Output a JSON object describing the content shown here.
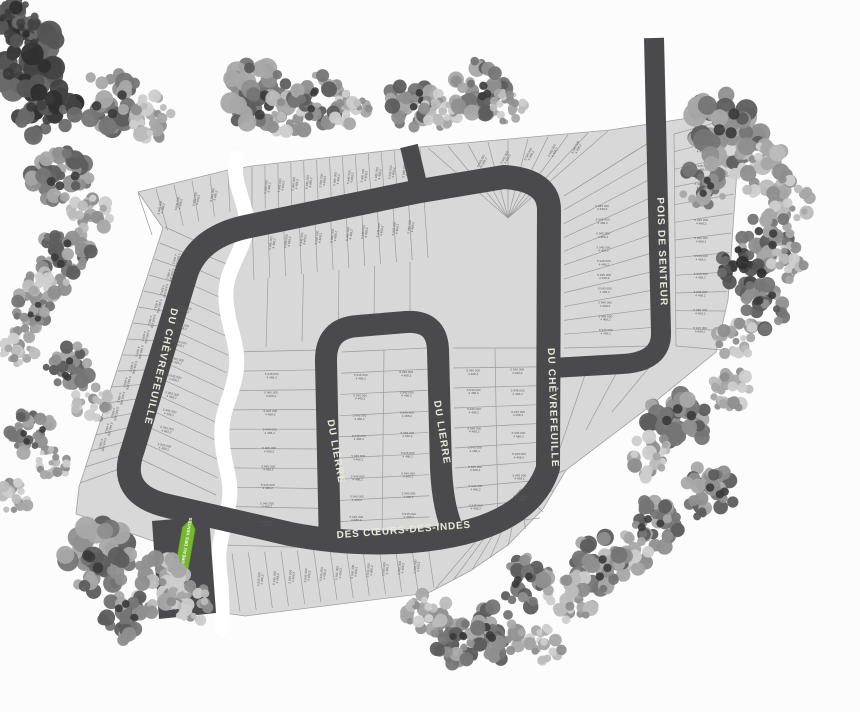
{
  "page": {
    "width": 860,
    "height": 712,
    "background": "#fcfcfc"
  },
  "palette": {
    "plat_fill": "#d8d8d8",
    "plat_line": "#9b9b9b",
    "plat_outline": "#a0a0a0",
    "road": "#4a4a4c",
    "road_text": "#e9e9db",
    "creek": "#ffffff",
    "lot_text": "#5d5d5d",
    "arrow_green": "#75b72e",
    "arrow_text": "#ffffff",
    "tree_tones": [
      [
        "#2f2f2f",
        "#424242",
        "#555555",
        "#6a6a6a"
      ],
      [
        "#5d5d5d",
        "#757575",
        "#8f8f8f",
        "#a8a8a8"
      ],
      [
        "#8e8e8e",
        "#a6a6a6",
        "#bcbcbc",
        "#cdcdcd"
      ]
    ]
  },
  "map": {
    "roads": [
      {
        "id": "du-chevrefeuille-west",
        "name": "DU CHÈVREFEUILLE",
        "label": {
          "x": 158,
          "y": 366,
          "rot": 103,
          "size": 10,
          "ls": 1.2
        }
      },
      {
        "id": "du-chevrefeuille-center",
        "name": "DU CHÈVREFEUILLE",
        "label": {
          "x": 550,
          "y": 408,
          "rot": 88,
          "size": 10,
          "ls": 1.2
        }
      },
      {
        "id": "pois-de-senteur",
        "name": "POIS DE SENTEUR",
        "label": {
          "x": 659,
          "y": 252,
          "rot": 88,
          "size": 10,
          "ls": 1.2
        }
      },
      {
        "id": "du-lierre-west",
        "name": "DU LIERRE",
        "label": {
          "x": 333,
          "y": 452,
          "rot": 80,
          "size": 10,
          "ls": 1.2
        }
      },
      {
        "id": "du-lierre-east",
        "name": "DU LIERRE",
        "label": {
          "x": 439,
          "y": 433,
          "rot": 81,
          "size": 10,
          "ls": 1.2
        }
      },
      {
        "id": "des-coeurs-des-indes",
        "name": "DES CŒURS-DES-INDES",
        "label": {
          "x": 404,
          "y": 533,
          "rot": -4.5,
          "size": 10,
          "ls": 0.8
        }
      }
    ],
    "sales_office": {
      "label": "BUREAU DES VENTES"
    },
    "lot_label": {
      "line1": "5 945 000",
      "line2": "4 468,2"
    },
    "geometry": {
      "outline": [
        [
          138,
          192
        ],
        [
          228,
          170
        ],
        [
          252,
          166
        ],
        [
          420,
          147
        ],
        [
          610,
          130
        ],
        [
          702,
          116
        ],
        [
          741,
          112
        ],
        [
          728,
          300
        ],
        [
          716,
          352
        ],
        [
          640,
          414
        ],
        [
          566,
          470
        ],
        [
          543,
          509
        ],
        [
          508,
          545
        ],
        [
          470,
          571
        ],
        [
          434,
          590
        ],
        [
          428,
          593
        ],
        [
          245,
          616
        ],
        [
          218,
          612
        ],
        [
          215,
          557
        ],
        [
          150,
          540
        ],
        [
          76,
          514
        ],
        [
          79,
          487
        ],
        [
          163,
          228
        ]
      ],
      "road_paths": [
        {
          "d": "M 250,226 Q 198,236 186,274 L 133,449 Q 116,494 168,506 L 290,534 Q 352,546 412,541 Q 528,531 548,468 L 549,210 Q 549,180 504,177 L 420,191 L 250,226 Z",
          "w": 24
        },
        {
          "d": "M 409,146 L 420,192",
          "w": 18
        },
        {
          "d": "M 654,38 L 661,332 Q 662,362 622,364 L 552,368",
          "w": 20
        },
        {
          "d": "M 330,549 L 326,362 Q 325,328 358,326 L 406,322 Q 437,320 438,350 L 441,468 Q 443,512 455,534",
          "w": 22
        }
      ],
      "entrance": [
        [
          152,
          521
        ],
        [
          209,
          516
        ],
        [
          216,
          613
        ],
        [
          159,
          619
        ]
      ],
      "creek": "M 237,158 C 230,185 250,205 246,230 C 242,255 224,270 226,300 C 228,330 240,345 236,372 C 232,399 220,410 222,440 C 224,470 234,480 228,508 C 222,536 216,550 220,575 C 223,595 221,612 223,630",
      "creek_width": 15,
      "blocks": [
        {
          "type": "strip",
          "a": [
            80,
            483
          ],
          "b": [
            165,
            227
          ],
          "d": [
            122,
            468
          ],
          "c": [
            200,
            243
          ],
          "n": 16
        },
        {
          "type": "strip",
          "a": [
            138,
            193
          ],
          "b": [
            228,
            172
          ],
          "d": [
            152,
            235
          ],
          "c": [
            230,
            212
          ],
          "n": 5
        },
        {
          "type": "strip",
          "a": [
            252,
            167
          ],
          "b": [
            420,
            148
          ],
          "d": [
            252,
            210
          ],
          "c": [
            424,
            192
          ],
          "n": 13
        },
        {
          "type": "fan",
          "center": [
            508,
            218
          ],
          "edge": [
            [
              428,
              148
            ],
            [
              608,
              131
            ]
          ],
          "n": 9
        },
        {
          "type": "strip",
          "a": [
            564,
            196
          ],
          "b": [
            564,
            348
          ],
          "d": [
            650,
            142
          ],
          "c": [
            652,
            346
          ],
          "n": 11
        },
        {
          "type": "line",
          "pts": [
            [
              564,
              196
            ],
            [
              648,
              143
            ]
          ]
        },
        {
          "type": "strip",
          "a": [
            674,
            134
          ],
          "b": [
            676,
            346
          ],
          "d": [
            740,
            116
          ],
          "c": [
            722,
            350
          ],
          "n": 12
        },
        {
          "type": "line",
          "pts": [
            [
              674,
              134
            ],
            [
              676,
              346
            ]
          ]
        },
        {
          "type": "strip",
          "a": [
            252,
            218
          ],
          "b": [
            424,
            198
          ],
          "d": [
            254,
            280
          ],
          "c": [
            428,
            258
          ],
          "n": 11
        },
        {
          "type": "strip",
          "a": [
            268,
            278
          ],
          "b": [
            410,
            262
          ],
          "d": [
            266,
            347
          ],
          "c": [
            410,
            324
          ],
          "n": 4
        },
        {
          "type": "strip",
          "a": [
            233,
            352
          ],
          "b": [
            225,
            545
          ],
          "d": [
            320,
            350
          ],
          "c": [
            322,
            548
          ],
          "n": 10
        },
        {
          "type": "strip",
          "a": [
            342,
            352
          ],
          "b": [
            335,
            543
          ],
          "d": [
            427,
            348
          ],
          "c": [
            430,
            538
          ],
          "n": 9
        },
        {
          "type": "line",
          "pts": [
            [
              384,
              350
            ],
            [
              382,
              540
            ]
          ]
        },
        {
          "type": "strip",
          "a": [
            453,
            348
          ],
          "b": [
            456,
            528
          ],
          "d": [
            537,
            348
          ],
          "c": [
            540,
            518
          ],
          "n": 9
        },
        {
          "type": "line",
          "pts": [
            [
              495,
              348
            ],
            [
              498,
              523
            ]
          ]
        },
        {
          "type": "strip",
          "a": [
            232,
            553
          ],
          "b": [
            428,
            546
          ],
          "d": [
            240,
            612
          ],
          "c": [
            434,
            588
          ],
          "n": 12
        },
        {
          "type": "fan",
          "center": [
            520,
            490
          ],
          "edge": [
            [
              565,
              470
            ],
            [
              543,
              512
            ],
            [
              508,
              546
            ],
            [
              472,
              570
            ],
            [
              436,
              588
            ]
          ],
          "n": 8
        },
        {
          "type": "strip",
          "a": [
            586,
            372
          ],
          "b": [
            652,
            364
          ],
          "d": [
            560,
            448
          ],
          "c": [
            612,
            412
          ],
          "n": 2
        },
        {
          "type": "strip",
          "a": [
            205,
            255
          ],
          "b": [
            138,
            458
          ],
          "d": [
            236,
            268
          ],
          "c": [
            216,
            495
          ],
          "n": 13
        }
      ],
      "lot_label_runs": [
        {
          "a": [
            100,
            452
          ],
          "b": [
            180,
            252
          ],
          "n": 13,
          "rot": 103
        },
        {
          "a": [
            152,
            210
          ],
          "b": [
            222,
            193
          ],
          "n": 4,
          "rot": -78
        },
        {
          "a": [
            260,
            188
          ],
          "b": [
            412,
            170
          ],
          "n": 11,
          "rot": -83
        },
        {
          "a": [
            470,
            163
          ],
          "b": [
            588,
            146
          ],
          "n": 5,
          "rot": -62
        },
        {
          "a": [
            602,
            200
          ],
          "b": [
            606,
            338
          ],
          "n": 10,
          "rot": 0
        },
        {
          "a": [
            702,
            140
          ],
          "b": [
            700,
            338
          ],
          "n": 11,
          "rot": 0
        },
        {
          "a": [
            264,
            244
          ],
          "b": [
            418,
            226
          ],
          "n": 10,
          "rot": -83
        },
        {
          "a": [
            186,
            300
          ],
          "b": [
            163,
            455
          ],
          "n": 9,
          "rot": 12
        },
        {
          "a": [
            272,
            366
          ],
          "b": [
            266,
            532
          ],
          "n": 9,
          "rot": 0
        },
        {
          "a": [
            361,
            366
          ],
          "b": [
            356,
            528
          ],
          "n": 8,
          "rot": 0
        },
        {
          "a": [
            406,
            363
          ],
          "b": [
            409,
            525
          ],
          "n": 8,
          "rot": 0
        },
        {
          "a": [
            473,
            362
          ],
          "b": [
            476,
            516
          ],
          "n": 8,
          "rot": 0
        },
        {
          "a": [
            517,
            360
          ],
          "b": [
            520,
            508
          ],
          "n": 7,
          "rot": 0
        },
        {
          "a": [
            252,
            580
          ],
          "b": [
            424,
            566
          ],
          "n": 11,
          "rot": -85
        }
      ],
      "arrow": {
        "x": 186,
        "y": 544,
        "rot": 10
      },
      "trees": [
        [
          22,
          60,
          42,
          0
        ],
        [
          46,
          108,
          34,
          0
        ],
        [
          14,
          22,
          24,
          0
        ],
        [
          112,
          100,
          34,
          1
        ],
        [
          150,
          118,
          25,
          2
        ],
        [
          257,
          97,
          36,
          1
        ],
        [
          290,
          113,
          26,
          2
        ],
        [
          318,
          100,
          27,
          1
        ],
        [
          352,
          112,
          22,
          2
        ],
        [
          412,
          103,
          27,
          1
        ],
        [
          440,
          112,
          20,
          2
        ],
        [
          478,
          88,
          30,
          1
        ],
        [
          508,
          107,
          18,
          2
        ],
        [
          726,
          128,
          40,
          1
        ],
        [
          762,
          168,
          30,
          2
        ],
        [
          704,
          184,
          26,
          1
        ],
        [
          790,
          200,
          24,
          2
        ],
        [
          766,
          240,
          30,
          1
        ],
        [
          740,
          270,
          24,
          0
        ],
        [
          764,
          306,
          28,
          1
        ],
        [
          737,
          338,
          22,
          2
        ],
        [
          788,
          262,
          20,
          2
        ],
        [
          676,
          420,
          34,
          1
        ],
        [
          648,
          456,
          26,
          2
        ],
        [
          728,
          390,
          24,
          2
        ],
        [
          710,
          492,
          30,
          1
        ],
        [
          654,
          524,
          28,
          1
        ],
        [
          627,
          556,
          24,
          2
        ],
        [
          600,
          562,
          30,
          1
        ],
        [
          571,
          597,
          26,
          2
        ],
        [
          526,
          582,
          28,
          1
        ],
        [
          497,
          633,
          30,
          1
        ],
        [
          543,
          643,
          22,
          2
        ],
        [
          459,
          641,
          26,
          1
        ],
        [
          428,
          616,
          24,
          2
        ],
        [
          100,
          558,
          38,
          1
        ],
        [
          158,
          583,
          30,
          2
        ],
        [
          128,
          616,
          28,
          1
        ],
        [
          191,
          603,
          22,
          2
        ],
        [
          14,
          500,
          20,
          2
        ],
        [
          60,
          178,
          32,
          1
        ],
        [
          90,
          217,
          24,
          2
        ],
        [
          66,
          253,
          28,
          1
        ],
        [
          46,
          289,
          24,
          2
        ],
        [
          32,
          310,
          22,
          1
        ],
        [
          18,
          348,
          20,
          2
        ],
        [
          70,
          368,
          26,
          1
        ],
        [
          92,
          403,
          20,
          2
        ],
        [
          32,
          433,
          24,
          1
        ],
        [
          54,
          463,
          18,
          2
        ]
      ]
    }
  }
}
